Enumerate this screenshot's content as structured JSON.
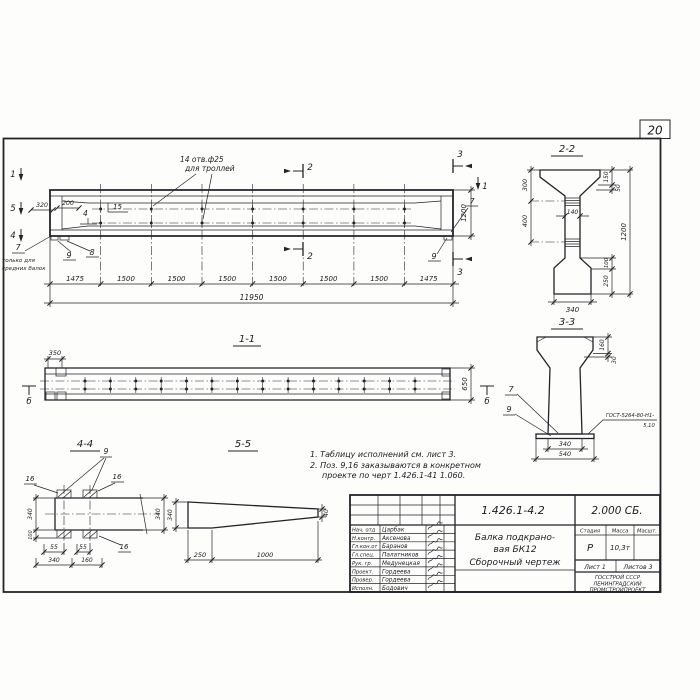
{
  "page": {
    "sheet_number": "20"
  },
  "elevation": {
    "holes_label_line1": "14 отв.ф25",
    "holes_label_line2": "для троллей",
    "pos_15": "15",
    "pos_4": "4",
    "dim_320": "320",
    "dim_200": "200",
    "pos_7_left": "7",
    "note_7_line1": "только для",
    "note_7_line2": "средних балок",
    "pos_9_left": "9",
    "pos_8": "8",
    "pos_7_right": "7",
    "pos_9_right": "9",
    "dim_1200": "1200",
    "dim_total": "11950",
    "dims_bottom": [
      "1475",
      "1500",
      "1500",
      "1500",
      "1500",
      "1500",
      "1500",
      "1475"
    ],
    "marker_1_left": "1",
    "marker_5": "5",
    "marker_4": "4",
    "marker_1_right": "1",
    "marker_2_top": "2",
    "marker_2_bottom": "2",
    "marker_3_top": "3",
    "marker_3_bottom": "3"
  },
  "section22": {
    "title": "2-2",
    "dim_300": "300",
    "dim_400": "400",
    "dim_140": "140",
    "dim_150": "150",
    "dim_50": "50",
    "dim_1200": "1200",
    "dim_100": "100",
    "dim_250": "250",
    "dim_340": "340"
  },
  "section33": {
    "title": "3-3",
    "dim_160": "160",
    "dim_30": "30",
    "pos_7": "7",
    "pos_9": "9",
    "weld_note_line1": "ГОСТ-5264-80-Н1-",
    "weld_note_line2": "5,10",
    "dim_340": "340",
    "dim_540": "540"
  },
  "section11": {
    "title": "1-1",
    "dim_350": "350",
    "dim_650": "650",
    "marker_b_left": "б",
    "marker_b_right": "б"
  },
  "section44": {
    "title": "4-4",
    "pos_9": "9",
    "pos_16_a": "16",
    "pos_16_b": "16",
    "pos_16_c": "16",
    "dim_340_left": "340",
    "dim_100": "100",
    "dim_55_a": "55",
    "dim_55_b": "55",
    "dim_340_bottom": "340",
    "dim_160": "160",
    "dim_340_right": "340"
  },
  "section55": {
    "title": "5-5",
    "dim_340": "340",
    "dim_40": "40",
    "dim_250": "250",
    "dim_1000": "1000"
  },
  "notes": {
    "line1": "1. Таблицу исполнений см. лист 3.",
    "line2": "2. Поз. 9,16 заказываются в конкретном",
    "line3": "проекте по черт 1.426.1-41 1.060."
  },
  "titleblock": {
    "doc_number": "1.426.1-4.2",
    "doc_mark": "2.000 СБ.",
    "title_line1": "Балка подкрано-",
    "title_line2": "вая БК12",
    "title_line3": "Сборочный чертеж",
    "stage_header": "Стадия",
    "mass_header": "Масса",
    "scale_header": "Масшт.",
    "stage_value": "Р",
    "mass_value": "10,3т",
    "sheet_label": "Лист 1",
    "sheets_label": "Листов 3",
    "org_line1": "ГОССТРОЙ СССР",
    "org_line2": "ЛЕНИНГРАДСКИЙ",
    "org_line3": "ПРОМСТРОЙПРОЕКТ",
    "staff": [
      {
        "role": "Нач. отд",
        "name": "Царбак"
      },
      {
        "role": "Н.контр.",
        "name": "Аксенова"
      },
      {
        "role": "Гл.кон.от",
        "name": "Баранов"
      },
      {
        "role": "Гл.спец.",
        "name": "Палатников"
      },
      {
        "role": "Рук. гр.",
        "name": "Медунецкая"
      },
      {
        "role": "Проект.",
        "name": "Гордеева"
      },
      {
        "role": "Провер.",
        "name": "Гордеева"
      },
      {
        "role": "Исполн.",
        "name": "Бодович"
      }
    ]
  }
}
